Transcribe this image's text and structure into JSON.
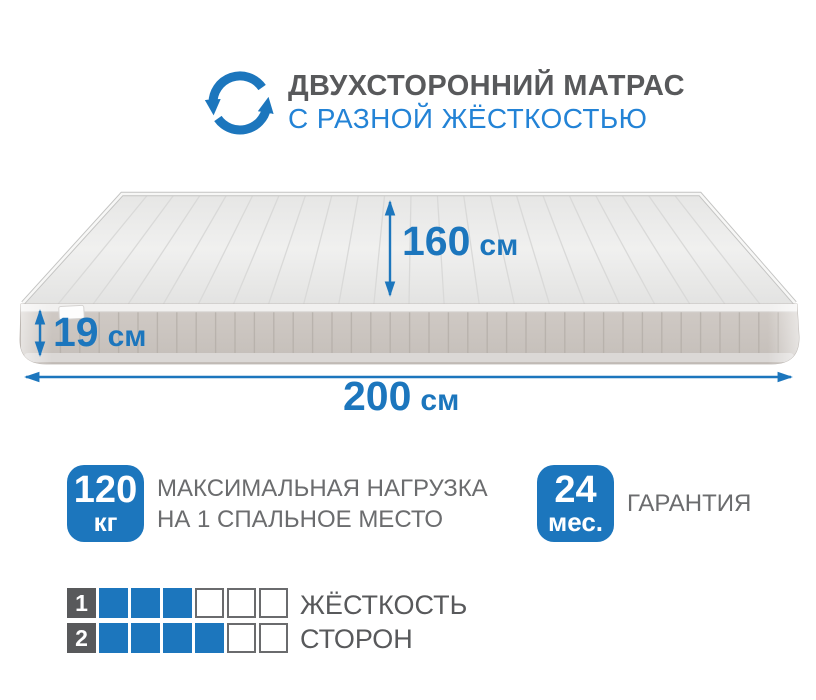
{
  "header": {
    "icon": "rotate-arrows-icon",
    "title": "ДВУХСТОРОННИЙ МАТРАС",
    "subtitle": "С РАЗНОЙ ЖЁСТКОСТЬЮ"
  },
  "dimensions": {
    "width": {
      "value": "160",
      "unit": "см"
    },
    "height": {
      "value": "19",
      "unit": "см"
    },
    "length": {
      "value": "200",
      "unit": "см"
    }
  },
  "badges": {
    "max_load": {
      "value": "120",
      "unit": "кг",
      "label_line1": "МАКСИМАЛЬНАЯ НАГРУЗКА",
      "label_line2": "НА 1 СПАЛЬНОЕ МЕСТО"
    },
    "warranty": {
      "value": "24",
      "unit": "мес.",
      "label": "ГАРАНТИЯ"
    }
  },
  "firmness": {
    "label_line1": "ЖЁСТКОСТЬ",
    "label_line2": "СТОРОН",
    "scale_max": 6,
    "rows": [
      {
        "side": "1",
        "filled": 3
      },
      {
        "side": "2",
        "filled": 4
      }
    ]
  },
  "colors": {
    "accent_blue": "#1c76bd",
    "subtitle_blue": "#2383d6",
    "title_gray": "#58595b",
    "text_gray": "#6b6c6e",
    "mattress_top": "#ebebea",
    "mattress_side": "#c8c2bd"
  }
}
